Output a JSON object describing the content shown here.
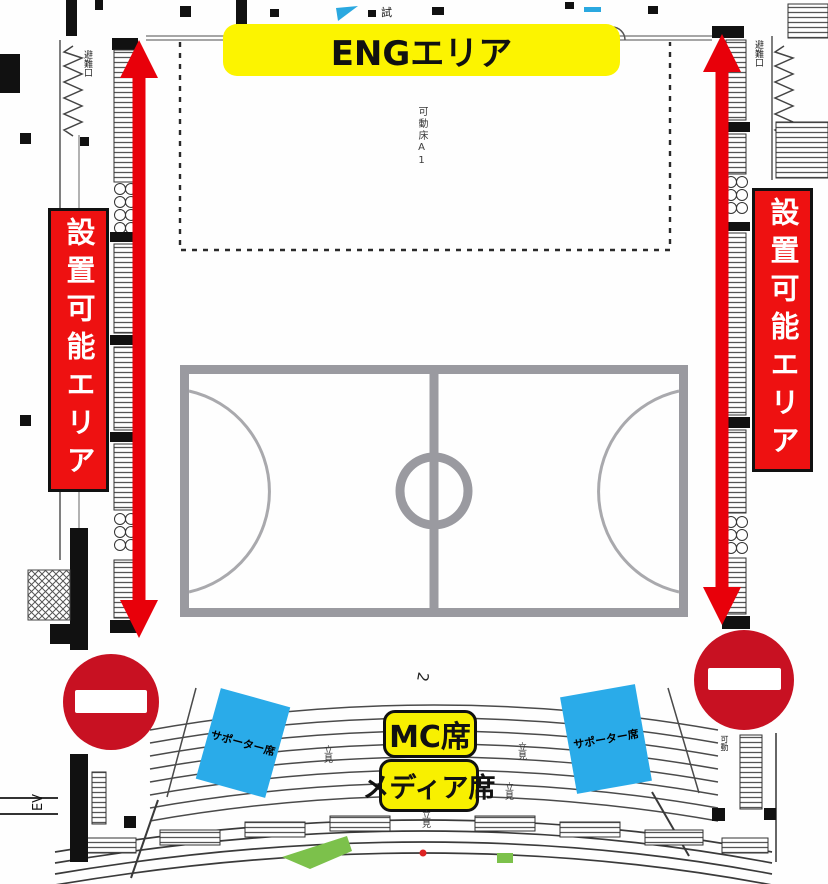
{
  "labels": {
    "eng_area": "ENGエリア",
    "install_area": "設置可能エリア",
    "mc_seat": "MC席",
    "media_seat": "メディア席",
    "supporter_seat": "サポーター席",
    "movable_floor": "可動床A1",
    "emergency_exit": "避難口",
    "elevator": "EV",
    "standing": "立見",
    "movable": "可動",
    "trial": "試",
    "row_number": "2"
  },
  "colors": {
    "banner_yellow": "#f8f000",
    "banner_red": "#ee1111",
    "arrow_red": "#e8000a",
    "supporter_blue": "#2aabe9",
    "no_entry_red": "#c81122",
    "court_gray": "#9a9aa0",
    "green_marker": "#7cc14b"
  }
}
